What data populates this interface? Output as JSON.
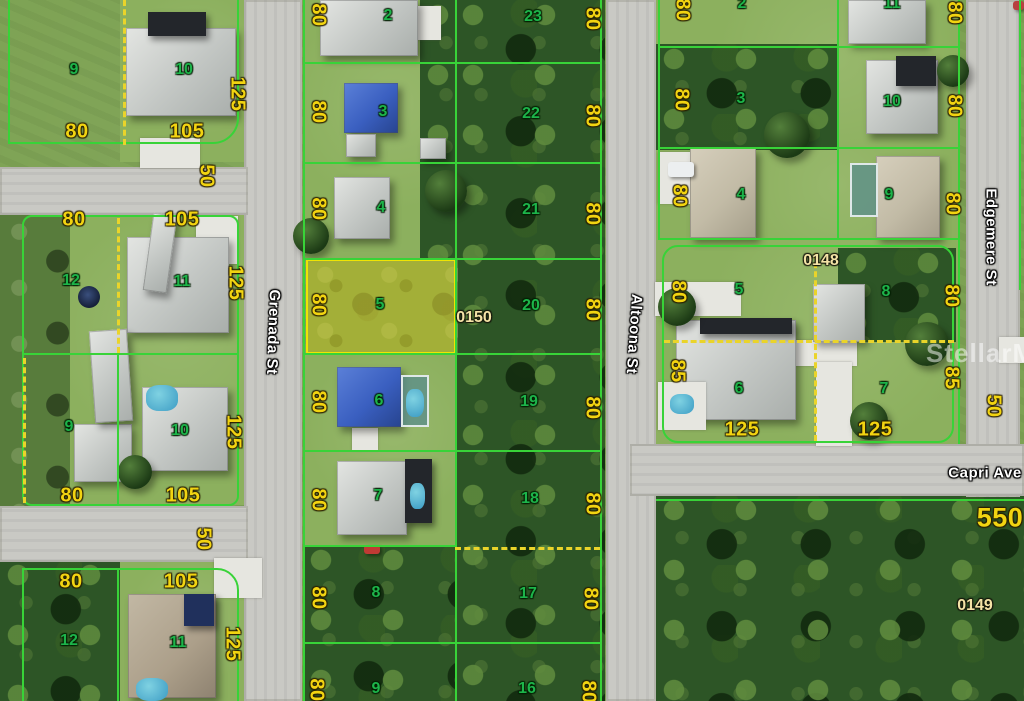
{
  "map": {
    "watermark": "StellarMLS",
    "streets": [
      {
        "name": "Grenada St"
      },
      {
        "name": "Altoona St"
      },
      {
        "name": "Edgemere St"
      },
      {
        "name": "Capri Ave"
      }
    ],
    "highlighted_lot": {
      "number": "5",
      "parcel_id": "0150"
    },
    "parcel_ids": [
      {
        "label": "0150",
        "x": 474,
        "y": 318
      },
      {
        "label": "0148",
        "x": 821,
        "y": 261
      },
      {
        "label": "0149",
        "x": 975,
        "y": 606
      }
    ],
    "lot_numbers": [
      {
        "n": "2",
        "x": 388,
        "y": 16
      },
      {
        "n": "23",
        "x": 533,
        "y": 17
      },
      {
        "n": "3",
        "x": 383,
        "y": 112
      },
      {
        "n": "22",
        "x": 531,
        "y": 114
      },
      {
        "n": "4",
        "x": 381,
        "y": 208
      },
      {
        "n": "21",
        "x": 531,
        "y": 210
      },
      {
        "n": "5",
        "x": 380,
        "y": 305
      },
      {
        "n": "20",
        "x": 531,
        "y": 306
      },
      {
        "n": "6",
        "x": 379,
        "y": 401
      },
      {
        "n": "19",
        "x": 529,
        "y": 402
      },
      {
        "n": "7",
        "x": 378,
        "y": 496
      },
      {
        "n": "18",
        "x": 530,
        "y": 499
      },
      {
        "n": "8",
        "x": 376,
        "y": 593
      },
      {
        "n": "17",
        "x": 528,
        "y": 594
      },
      {
        "n": "9",
        "x": 376,
        "y": 689
      },
      {
        "n": "16",
        "x": 527,
        "y": 689
      },
      {
        "n": "9",
        "x": 74,
        "y": 70
      },
      {
        "n": "10",
        "x": 184,
        "y": 70
      },
      {
        "n": "12",
        "x": 71,
        "y": 281
      },
      {
        "n": "11",
        "x": 182,
        "y": 282
      },
      {
        "n": "9",
        "x": 69,
        "y": 427
      },
      {
        "n": "10",
        "x": 180,
        "y": 431
      },
      {
        "n": "12",
        "x": 69,
        "y": 641
      },
      {
        "n": "11",
        "x": 178,
        "y": 643
      },
      {
        "n": "2",
        "x": 742,
        "y": 4
      },
      {
        "n": "11",
        "x": 892,
        "y": 4
      },
      {
        "n": "3",
        "x": 741,
        "y": 99
      },
      {
        "n": "10",
        "x": 892,
        "y": 102
      },
      {
        "n": "4",
        "x": 741,
        "y": 195
      },
      {
        "n": "9",
        "x": 889,
        "y": 195
      },
      {
        "n": "5",
        "x": 739,
        "y": 290
      },
      {
        "n": "8",
        "x": 886,
        "y": 292
      },
      {
        "n": "6",
        "x": 739,
        "y": 389
      },
      {
        "n": "7",
        "x": 884,
        "y": 389
      }
    ],
    "dimensions": [
      {
        "t": "80",
        "x": 318,
        "y": 15,
        "rot": true
      },
      {
        "t": "80",
        "x": 592,
        "y": 19,
        "rot": true
      },
      {
        "t": "80",
        "x": 318,
        "y": 112,
        "rot": true
      },
      {
        "t": "80",
        "x": 592,
        "y": 116,
        "rot": true
      },
      {
        "t": "80",
        "x": 318,
        "y": 209,
        "rot": true
      },
      {
        "t": "80",
        "x": 592,
        "y": 214,
        "rot": true
      },
      {
        "t": "80",
        "x": 318,
        "y": 305,
        "rot": true
      },
      {
        "t": "80",
        "x": 592,
        "y": 310,
        "rot": true
      },
      {
        "t": "80",
        "x": 318,
        "y": 402,
        "rot": true
      },
      {
        "t": "80",
        "x": 592,
        "y": 408,
        "rot": true
      },
      {
        "t": "80",
        "x": 318,
        "y": 500,
        "rot": true
      },
      {
        "t": "80",
        "x": 592,
        "y": 504,
        "rot": true
      },
      {
        "t": "80",
        "x": 318,
        "y": 598,
        "rot": true
      },
      {
        "t": "80",
        "x": 590,
        "y": 599,
        "rot": true
      },
      {
        "t": "80",
        "x": 316,
        "y": 690,
        "rot": true
      },
      {
        "t": "80",
        "x": 588,
        "y": 692,
        "rot": true
      },
      {
        "t": "125",
        "x": 237,
        "y": 94,
        "rot": true
      },
      {
        "t": "80",
        "x": 77,
        "y": 132
      },
      {
        "t": "105",
        "x": 187,
        "y": 132
      },
      {
        "t": "50",
        "x": 206,
        "y": 176,
        "rot": true
      },
      {
        "t": "80",
        "x": 74,
        "y": 220
      },
      {
        "t": "105",
        "x": 182,
        "y": 220
      },
      {
        "t": "125",
        "x": 235,
        "y": 283,
        "rot": true
      },
      {
        "t": "125",
        "x": 233,
        "y": 432,
        "rot": true
      },
      {
        "t": "80",
        "x": 72,
        "y": 496
      },
      {
        "t": "105",
        "x": 183,
        "y": 496
      },
      {
        "t": "50",
        "x": 203,
        "y": 539,
        "rot": true
      },
      {
        "t": "80",
        "x": 71,
        "y": 582
      },
      {
        "t": "105",
        "x": 181,
        "y": 582
      },
      {
        "t": "125",
        "x": 232,
        "y": 644,
        "rot": true
      },
      {
        "t": "80",
        "x": 682,
        "y": 10,
        "rot": true
      },
      {
        "t": "80",
        "x": 954,
        "y": 13,
        "rot": true
      },
      {
        "t": "80",
        "x": 681,
        "y": 100,
        "rot": true
      },
      {
        "t": "80",
        "x": 954,
        "y": 106,
        "rot": true
      },
      {
        "t": "80",
        "x": 679,
        "y": 196,
        "rot": true
      },
      {
        "t": "80",
        "x": 952,
        "y": 204,
        "rot": true
      },
      {
        "t": "80",
        "x": 678,
        "y": 292,
        "rot": true
      },
      {
        "t": "80",
        "x": 951,
        "y": 296,
        "rot": true
      },
      {
        "t": "85",
        "x": 677,
        "y": 371,
        "rot": true
      },
      {
        "t": "85",
        "x": 951,
        "y": 378,
        "rot": true
      },
      {
        "t": "125",
        "x": 742,
        "y": 430
      },
      {
        "t": "125",
        "x": 875,
        "y": 430
      },
      {
        "t": "50",
        "x": 993,
        "y": 406,
        "rot": true
      },
      {
        "t": "550",
        "x": 1000,
        "y": 518,
        "big": true
      }
    ],
    "colors": {
      "lot_line": "#38d338",
      "lot_number": "#1db44a",
      "dimension_label": "#f2d411",
      "parcel_id": "#f4e3a6",
      "highlight_fill": "#e1d834",
      "dashed_line": "#ead42a",
      "street_label": "#ffffff"
    }
  }
}
